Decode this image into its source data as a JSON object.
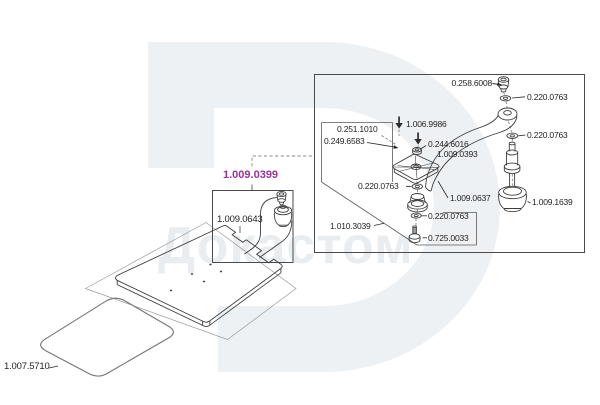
{
  "diagram": {
    "watermark_text": "Докастом",
    "highlight_color": "#993399"
  },
  "part_numbers": {
    "assembly_highlight": "1.009.0399",
    "plate": "1.009.0643",
    "mat": "1.007.5710",
    "cap_screw": "0.258.6008",
    "washer": "0.220.0763",
    "screw_top": "1.006.9986",
    "nut": "0.244.6016",
    "screw_plate": "1.009.0393",
    "bracket_upper": "0.251.1010",
    "bracket_lower": "0.249.6583",
    "arm": "1.009.0637",
    "foot": "1.009.1639",
    "base_assembly": "1.010.3039",
    "bolt": "0.725.0033"
  }
}
